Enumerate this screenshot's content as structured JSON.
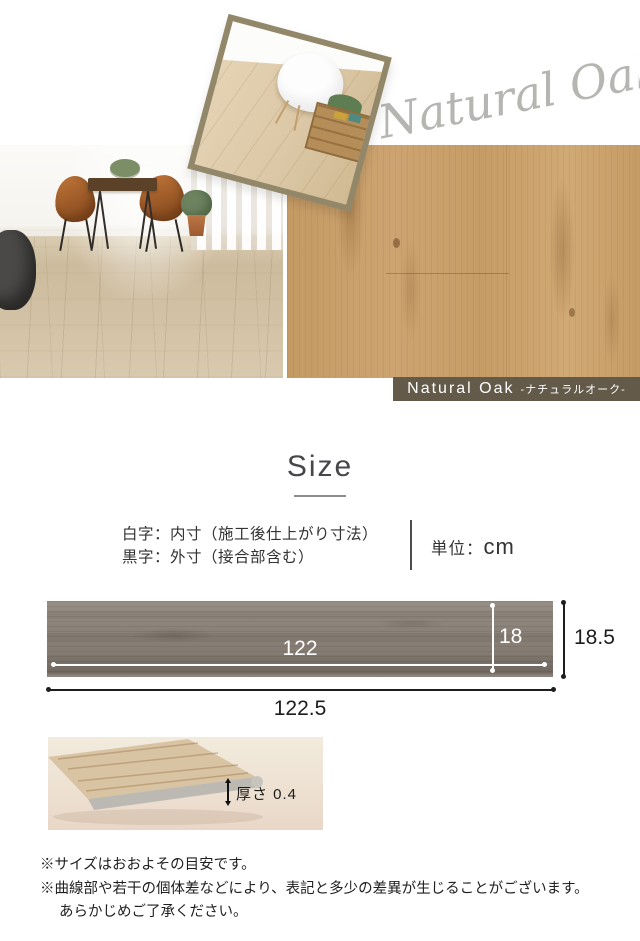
{
  "hero": {
    "script_text": "Natural Oak",
    "badge": {
      "name_en": "Natural Oak",
      "name_ja": "-ナチュラルオーク-"
    },
    "colors": {
      "badge_bg": "#635a49",
      "script_gray": "#b5b5b2",
      "inset_border": "#93876a",
      "oak_base": "#c79e69",
      "diagram_plank_gray": "#8a8178"
    }
  },
  "size_section": {
    "title": "Size",
    "legend": {
      "line1": "白字：内寸（施工後仕上がり寸法）",
      "line2": "黒字：外寸（接合部含む）",
      "unit_label": "単位：",
      "unit_value": "cm"
    },
    "diagram": {
      "inner_length": "122",
      "inner_width": "18",
      "outer_width": "18.5",
      "outer_length": "122.5"
    },
    "thickness": {
      "label": "厚さ 0.4"
    },
    "notes": {
      "line1": "※サイズはおおよその目安です。",
      "line2": "※曲線部や若干の個体差などにより、表記と多少の差異が生じることがございます。",
      "line3": "あらかじめご了承ください。"
    }
  }
}
